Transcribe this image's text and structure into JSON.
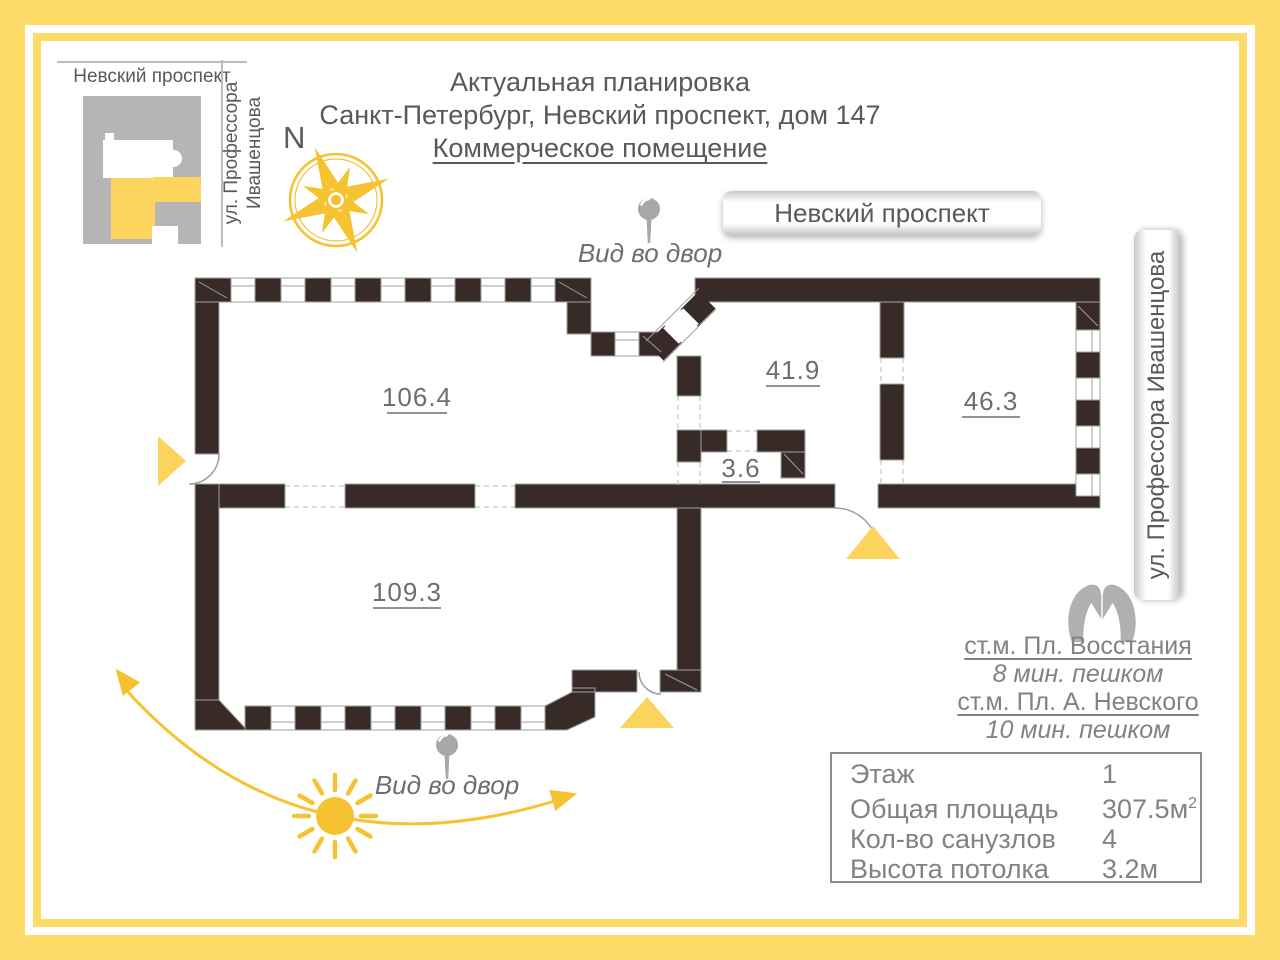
{
  "colors": {
    "frame_yellow": "#fcdb69",
    "accent_yellow": "#f5c332",
    "triangle_yellow": "#fbd45e",
    "wall": "#382b27",
    "text_dark": "#58595b",
    "text_mid": "#6d6e71",
    "text_light": "#808285",
    "map_gray": "#b5b5b6",
    "pin_gray": "#a8a8a8"
  },
  "minimap": {
    "street_top": "Невский проспект",
    "street_side": "ул. Профессора Ивашенцова"
  },
  "compass": {
    "north": "N"
  },
  "title": {
    "line1": "Актуальная планировка",
    "line2": "Санкт-Петербург, Невский проспект, дом 147",
    "line3": "Коммерческое помещение"
  },
  "street_bands": {
    "top": "Невский проспект",
    "right": "ул. Профессора Ивашенцова"
  },
  "view_labels": {
    "top": "Вид во двор",
    "bottom": "Вид во двор"
  },
  "plan": {
    "rooms": [
      {
        "id": "room-106-4",
        "area": "106.4"
      },
      {
        "id": "room-41-9",
        "area": "41.9"
      },
      {
        "id": "room-46-3",
        "area": "46.3"
      },
      {
        "id": "room-3-6",
        "area": "3.6"
      },
      {
        "id": "room-109-3",
        "area": "109.3"
      }
    ]
  },
  "metro": {
    "station1": "ст.м. Пл. Восстания",
    "walk1": "8 мин. пешком",
    "station2": "ст.м. Пл. А. Невского",
    "walk2": "10 мин. пешком"
  },
  "stats": {
    "rows": [
      {
        "label": "Этаж",
        "value": "1"
      },
      {
        "label": "Общая площадь",
        "value": "307.5м",
        "sup": "2"
      },
      {
        "label": "Кол-во санузлов",
        "value": "4"
      },
      {
        "label": "Высота потолка",
        "value": "3.2м"
      }
    ]
  }
}
